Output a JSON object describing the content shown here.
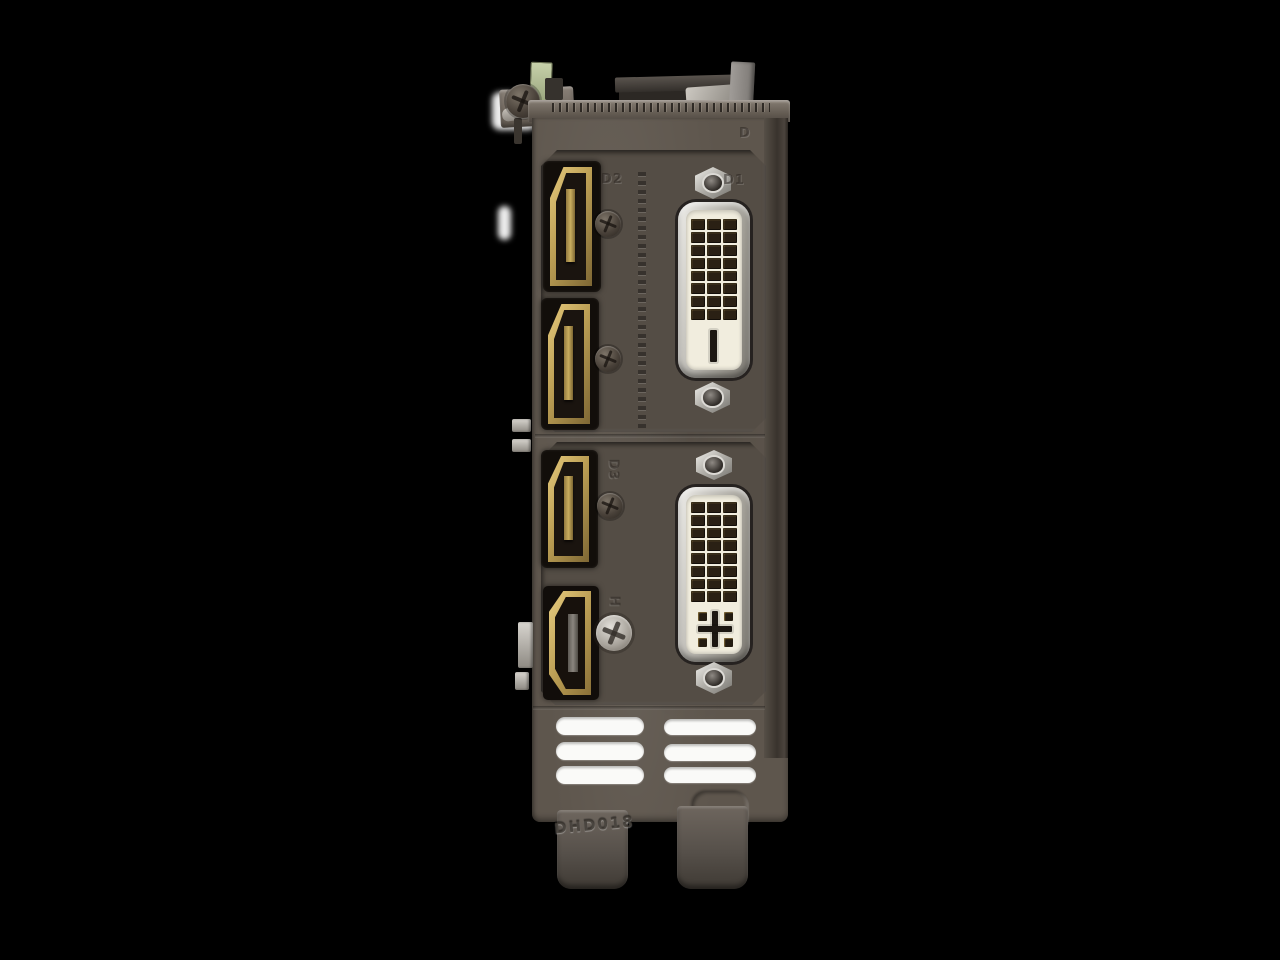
{
  "scene": {
    "type": "product-photo",
    "subject": "Rear I/O bracket of a dual-slot graphics card photographed vertically",
    "background_color": "#000000"
  },
  "bracket": {
    "metal_color": "#5e564d",
    "panel_color": "#544d45",
    "stamp_text": "DHD018",
    "corner_mark": "D",
    "ports": {
      "displayport_1": {
        "type": "DisplayPort",
        "label": "D2"
      },
      "displayport_2": {
        "type": "DisplayPort",
        "label": ""
      },
      "displayport_3": {
        "type": "DisplayPort",
        "label": "D3"
      },
      "hdmi": {
        "type": "HDMI",
        "label": "H"
      },
      "dvi_top": {
        "type": "DVI-D Dual Link",
        "label": "D1"
      },
      "dvi_bottom": {
        "type": "DVI-I Dual Link",
        "label": ""
      }
    },
    "colors": {
      "port_gold": "#c9ab5f",
      "dvi_chrome": "#c6c4bf",
      "dvi_insert": "#f1edde",
      "vent_slot": "#fafaf8"
    },
    "vents": {
      "columns": 2,
      "rows": 3
    }
  }
}
